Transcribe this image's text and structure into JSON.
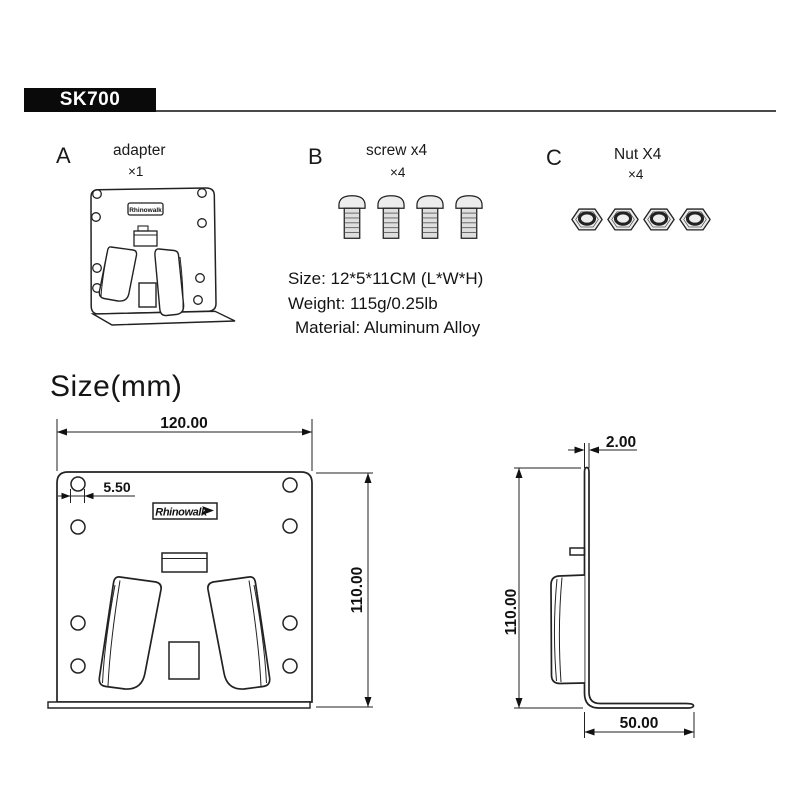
{
  "header": {
    "model": "SK700"
  },
  "parts": [
    {
      "letter": "A",
      "name": "adapter",
      "qty": "×1"
    },
    {
      "letter": "B",
      "name": "screw x4",
      "qty": "×4"
    },
    {
      "letter": "C",
      "name": "Nut X4",
      "qty": "×4"
    }
  ],
  "specs": {
    "size": "Size: 12*5*11CM (L*W*H)",
    "weight": "Weight: 115g/0.25lb",
    "material": "Material: Aluminum Alloy"
  },
  "brand": "Rhinowalk",
  "size_section": {
    "title": "Size(mm)",
    "front_view": {
      "width_mm": "120.00",
      "hole_mm": "5.50",
      "height_mm": "110.00"
    },
    "side_view": {
      "thickness_mm": "2.00",
      "height_mm": "110.00",
      "depth_mm": "50.00"
    }
  }
}
